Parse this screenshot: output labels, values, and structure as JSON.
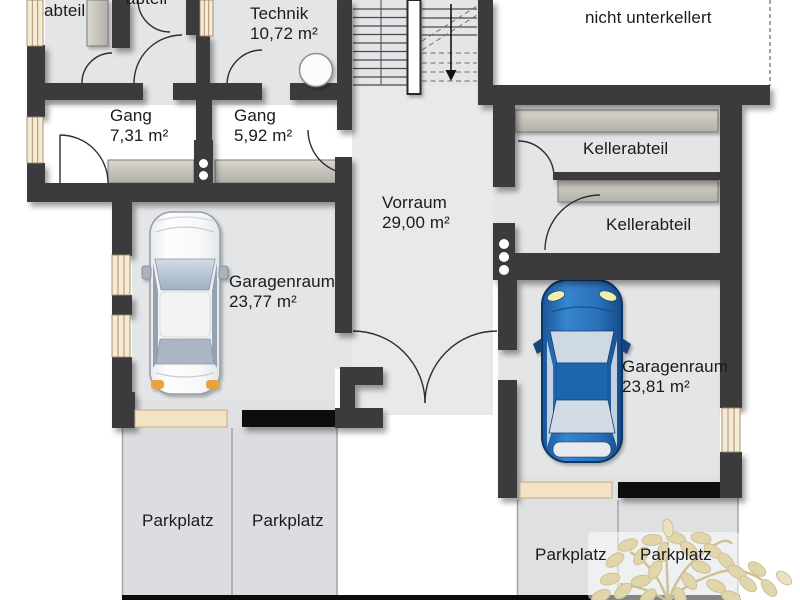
{
  "rooms": {
    "abteil_top_left": {
      "label": "abteil"
    },
    "abteil_top_center": {
      "label": "abteil"
    },
    "technik": {
      "label": "Technik",
      "area": "10,72 m²"
    },
    "nicht_unterkellert": {
      "label": "nicht unterkellert"
    },
    "gang_west": {
      "label": "Gang",
      "area": "7,31 m²"
    },
    "gang_east": {
      "label": "Gang",
      "area": "5,92 m²"
    },
    "kellerabteil_1": {
      "label": "Kellerabteil"
    },
    "kellerabteil_2": {
      "label": "Kellerabteil"
    },
    "vorraum": {
      "label": "Vorraum",
      "area": "29,00 m²"
    },
    "garage_west": {
      "label": "Garagenraum",
      "area": "23,77 m²"
    },
    "garage_east": {
      "label": "Garagenraum",
      "area": "23,81 m²"
    }
  },
  "parking": {
    "labels": [
      "Parkplatz",
      "Parkplatz",
      "Parkplatz",
      "Parkplatz"
    ]
  },
  "colors": {
    "wall": "#3a3a3c",
    "black_strip": "#070707",
    "floor": "#e4e5e7",
    "window": "#f6ead6",
    "garage_door": "#f3e2c4",
    "shelf": "#ccc8c2",
    "parking_area": "#dcdde0",
    "car_blue": "#2a6fc0",
    "car_white": "#f4f5f7",
    "tree_leaf": "#e0d6aa"
  }
}
